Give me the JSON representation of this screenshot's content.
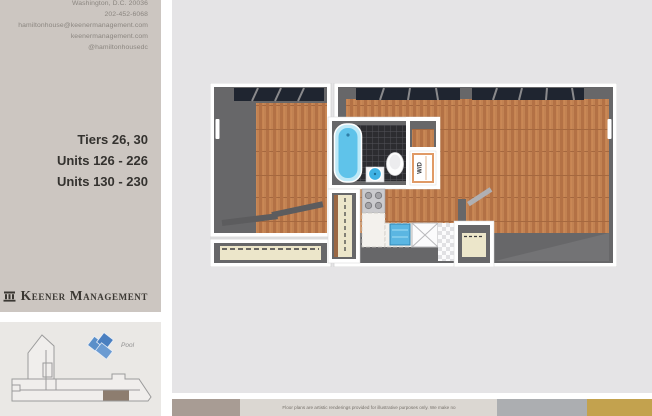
{
  "sidebar": {
    "contact_lines": [
      "Washington, D.C.  20036",
      "202-452-6068",
      "hamiltonhouse@keenermanagement.com",
      "keenermanagement.com",
      "@hamiltonhousedc"
    ],
    "unit_lines": [
      "Tiers 26, 30",
      "Units 126 - 226",
      "Units 130 - 230"
    ],
    "brand_name": "Keener Management",
    "pool_label": "Pool"
  },
  "floor_plan": {
    "washer_dryer_label": "W/D"
  },
  "footer": {
    "disclaimer": "Floor plans are artistic renderings provided for illustrative purposes only. We make no"
  },
  "colors": {
    "sidebar_bg": "#ccc6c1",
    "site_bg": "#eae8e5",
    "panel_bg": "#e5e4e6",
    "bar_taupe": "#a89c94",
    "bar_beige": "#dbd7d2",
    "bar_gray": "#acaeb1",
    "bar_gold": "#c3a24e",
    "pool_blue": "#5b8fc9",
    "wood": "#c28252",
    "tub_blue": "#5fc3ea",
    "wall_gray": "#676769"
  }
}
